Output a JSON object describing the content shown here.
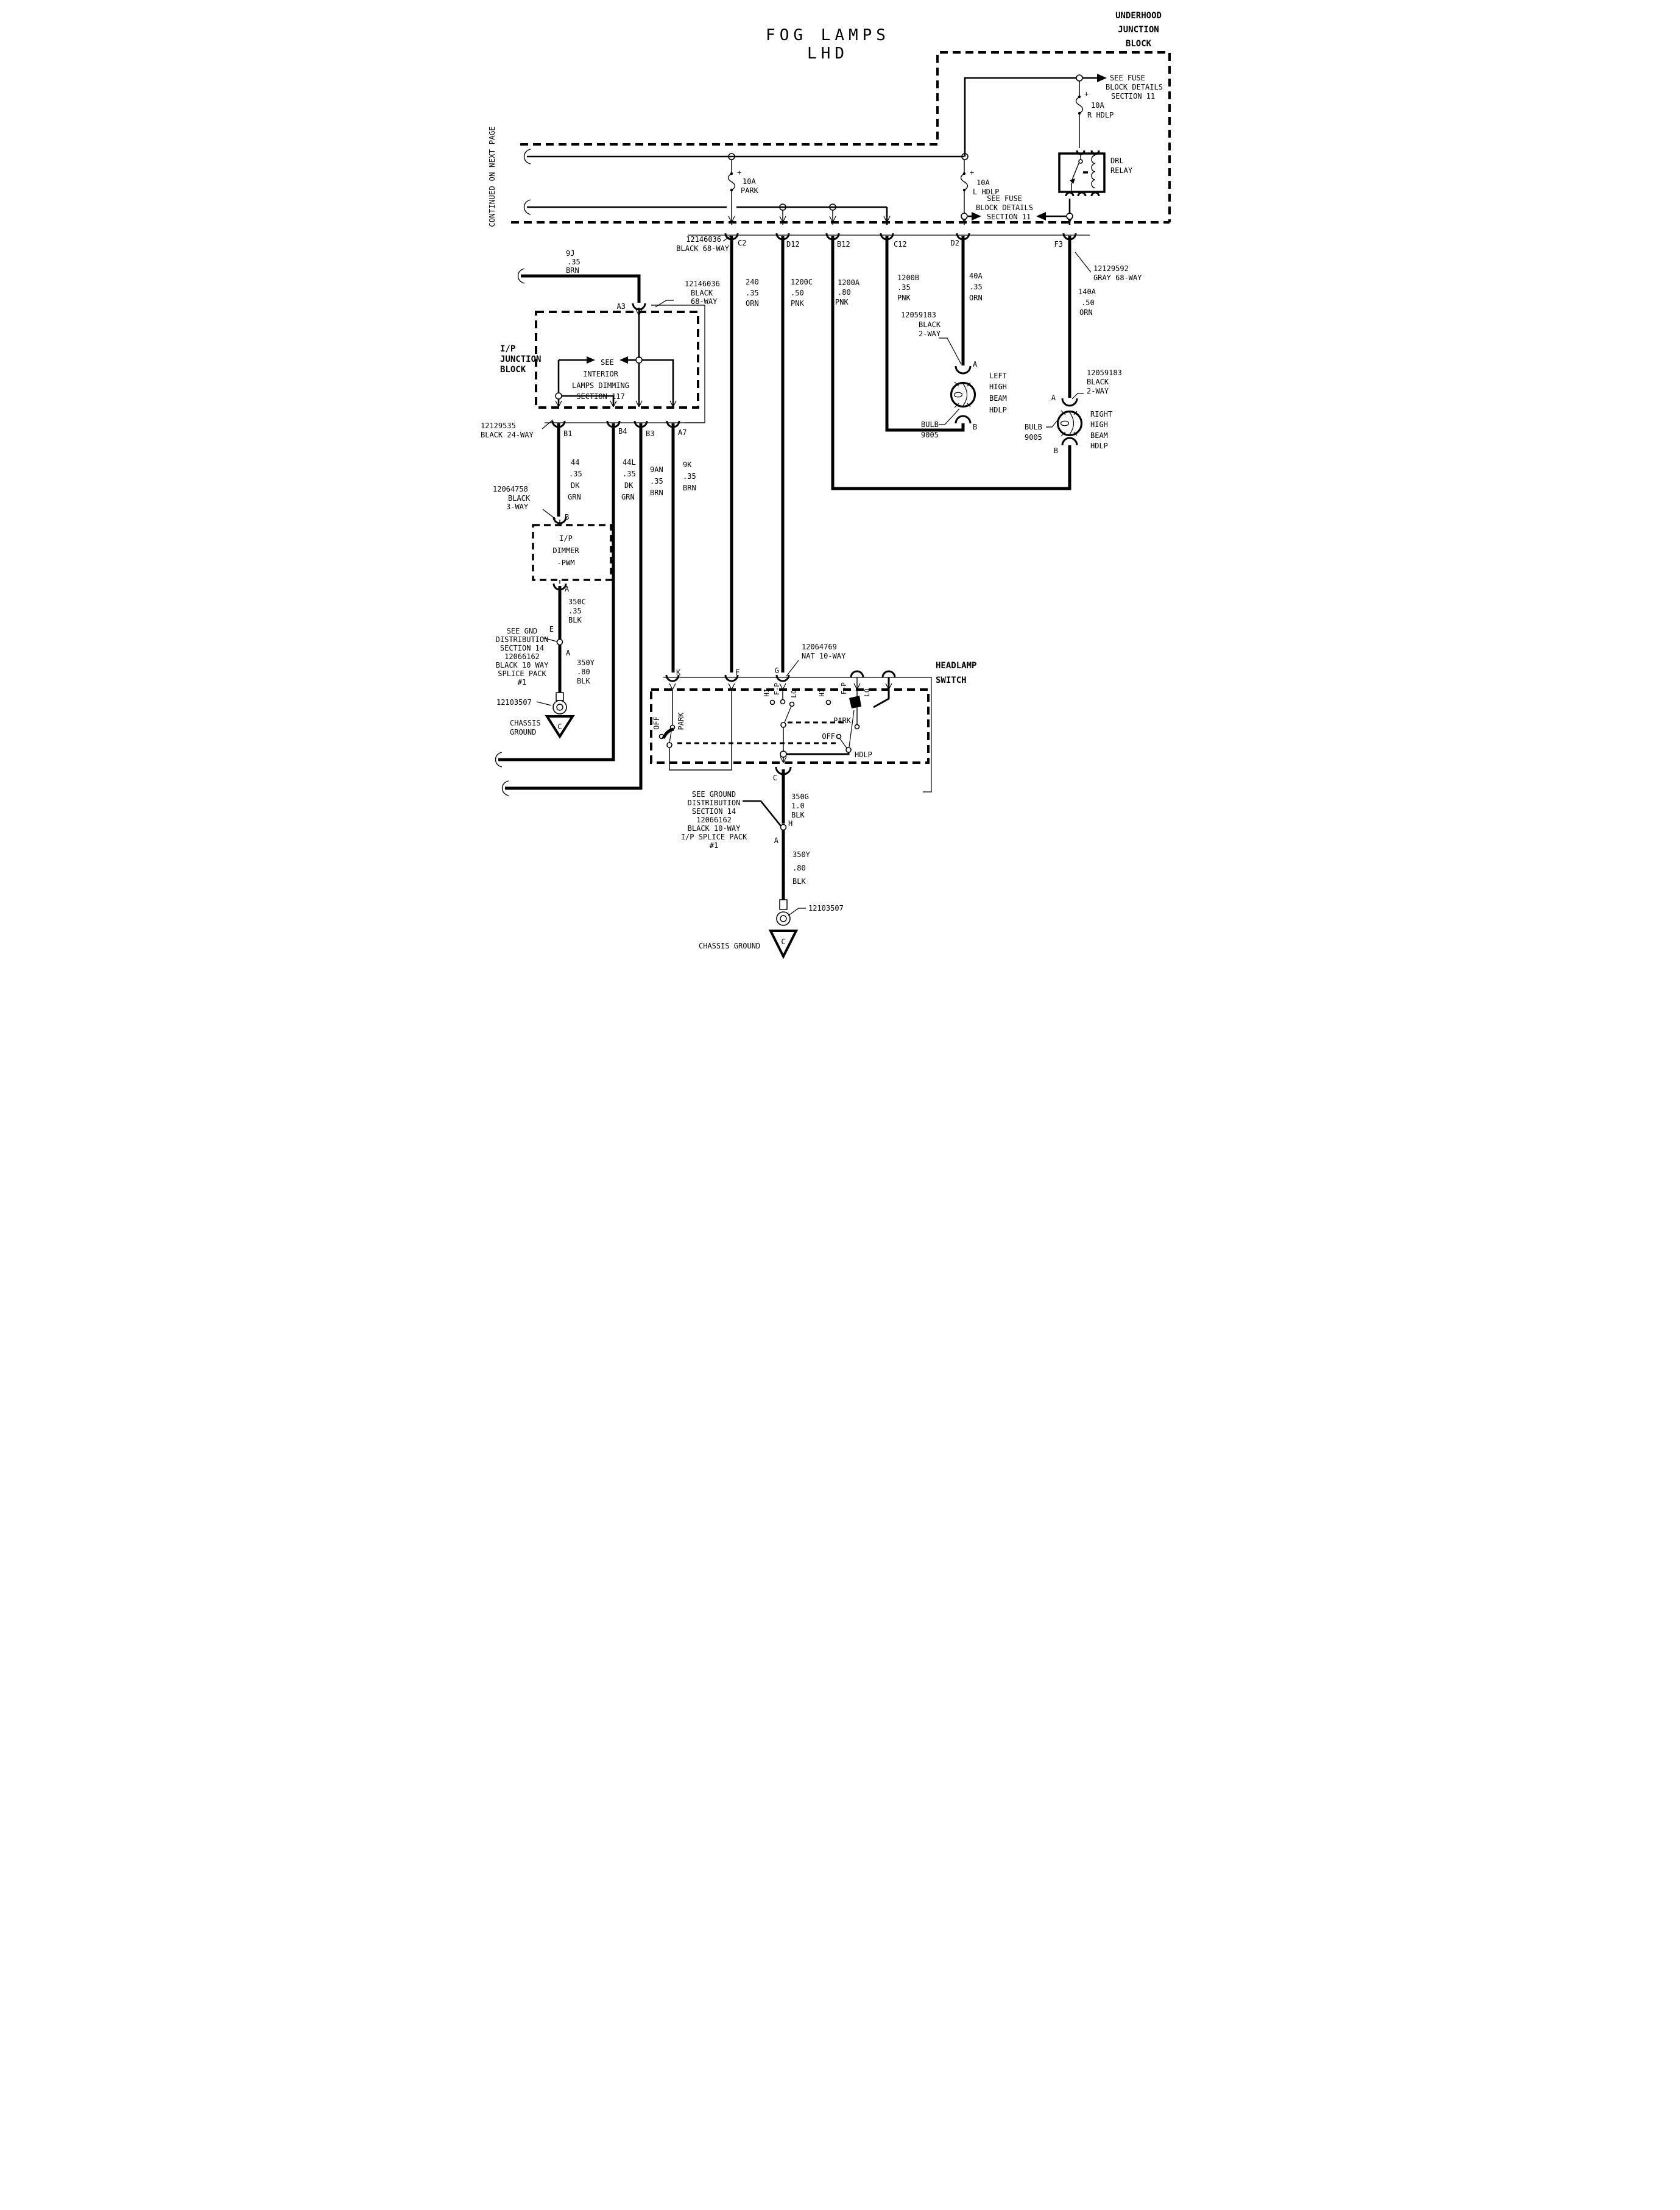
{
  "colors": {
    "ink": "#000000",
    "paper": "#ffffff"
  },
  "title": {
    "line1": "FOG LAMPS",
    "line2": "LHD"
  },
  "page": {
    "continued": "CONTINUED ON NEXT PAGE"
  },
  "uhjb": {
    "label": [
      "UNDERHOOD",
      "JUNCTION",
      "BLOCK"
    ],
    "see_fuse_top": [
      "SEE FUSE",
      "BLOCK DETAILS",
      "SECTION 11"
    ],
    "see_fuse_mid": [
      "SEE FUSE",
      "BLOCK DETAILS",
      "SECTION 11"
    ],
    "fuse_park": {
      "plus": "+",
      "amp": "10A",
      "name": "PARK"
    },
    "fuse_l": {
      "plus": "+",
      "amp": "10A",
      "name": "L HDLP"
    },
    "fuse_r": {
      "plus": "+",
      "amp": "10A",
      "name": "R HDLP"
    },
    "relay": [
      "DRL",
      "RELAY"
    ]
  },
  "conn_row": {
    "label_top": [
      "12146036",
      "BLACK 68-WAY"
    ],
    "label_right": [
      "12129592",
      "GRAY 68-WAY"
    ],
    "pins": {
      "c2": "C2",
      "d12": "D12",
      "b12": "B12",
      "c12": "C12",
      "d2": "D2",
      "f3": "F3"
    }
  },
  "wires": {
    "w9j": [
      "9J",
      ".35",
      "BRN"
    ],
    "w240": [
      "240",
      ".35",
      "ORN"
    ],
    "w1200c": [
      "1200C",
      ".50",
      "PNK"
    ],
    "w1200a": [
      "1200A",
      ".80",
      "PNK"
    ],
    "w1200b": [
      "1200B",
      ".35",
      "PNK"
    ],
    "w40a": [
      "40A",
      ".35",
      "ORN"
    ],
    "w140a": [
      "140A",
      ".50",
      "ORN"
    ],
    "w44": [
      "44",
      ".35",
      "DK",
      "GRN"
    ],
    "w44l": [
      "44L",
      ".35",
      "DK",
      "GRN"
    ],
    "w9an": [
      "9AN",
      ".35",
      "BRN"
    ],
    "w9k": [
      "9K",
      ".35",
      "BRN"
    ],
    "w350c": [
      "350C",
      ".35",
      "BLK"
    ],
    "w350y": [
      "350Y",
      ".80",
      "BLK"
    ],
    "w350g": [
      "350G",
      "1.0",
      "BLK"
    ],
    "w350y2": [
      "350Y",
      ".80",
      "BLK"
    ]
  },
  "ip_block": {
    "label": [
      "I/P",
      "JUNCTION",
      "BLOCK"
    ],
    "a3": "A3",
    "conn_a3": [
      "12146036",
      "BLACK",
      "68-WAY"
    ],
    "see_interior": [
      "SEE",
      "INTERIOR",
      "LAMPS DIMMING",
      "SECTION 117"
    ],
    "conn_24": [
      "12129535",
      "BLACK 24-WAY"
    ],
    "pins": {
      "b1": "B1",
      "b4": "B4",
      "b3": "B3",
      "a7": "A7"
    }
  },
  "dimmer": {
    "conn": [
      "12064758",
      "BLACK",
      "3-WAY"
    ],
    "pin_b": "B",
    "pin_a": "A",
    "box": [
      "I/P",
      "DIMMER",
      "-PWM"
    ]
  },
  "gnd_left": {
    "e": "E",
    "a": "A",
    "note": [
      "SEE GND",
      "DISTRIBUTION",
      "SECTION 14",
      "12066162",
      "BLACK 10 WAY",
      "SPLICE PACK",
      "#1"
    ],
    "ring": "12103507",
    "chassis": [
      "CHASSIS",
      "GROUND"
    ],
    "c": "C"
  },
  "lamps": {
    "left": {
      "conn": [
        "12059183",
        "BLACK",
        "2-WAY"
      ],
      "a": "A",
      "b": "B",
      "name": [
        "LEFT",
        "HIGH",
        "BEAM",
        "HDLP"
      ],
      "bulb": [
        "BULB",
        "9005"
      ]
    },
    "right": {
      "conn": [
        "12059183",
        "BLACK",
        "2-WAY"
      ],
      "a": "A",
      "b": "B",
      "name": [
        "RIGHT",
        "HIGH",
        "BEAM",
        "HDLP"
      ],
      "bulb": [
        "BULB",
        "9005"
      ]
    }
  },
  "hlswitch": {
    "label": [
      "HEADLAMP",
      "SWITCH"
    ],
    "conn": [
      "12064769",
      "NAT 10-WAY"
    ],
    "pins": {
      "k": "K",
      "f": "F",
      "g": "G",
      "c": "C"
    },
    "dimmer1": {
      "hi": "HI",
      "fp": "F-P",
      "lo": "LO"
    },
    "dimmer2": {
      "hi": "HI",
      "fp": "F-P",
      "lo": "LO"
    },
    "main_left": {
      "off": "OFF",
      "park": "PARK"
    },
    "main_right": {
      "park": "PARK",
      "off": "OFF",
      "hdlp": "HDLP"
    }
  },
  "gnd_bottom": {
    "h": "H",
    "a": "A",
    "note": [
      "SEE GROUND",
      "DISTRIBUTION",
      "SECTION 14",
      "12066162",
      "BLACK 10-WAY",
      "I/P SPLICE PACK",
      "#1"
    ],
    "ring": "12103507",
    "chassis": "CHASSIS GROUND",
    "c": "C"
  }
}
